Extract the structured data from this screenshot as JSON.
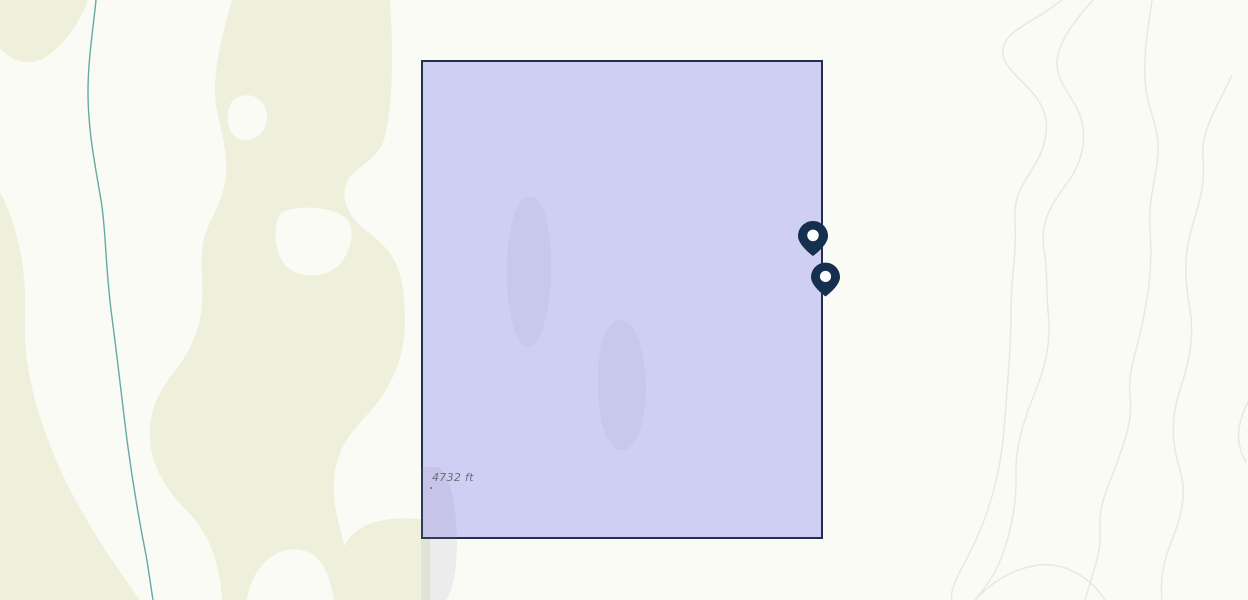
{
  "map": {
    "elevation_marker": {
      "label": "4732 ft"
    },
    "selection": {
      "fill_color": "#cfcef3",
      "border_color": "#22304f"
    },
    "markers": [
      {
        "id": "marker-1",
        "color": "#14304e"
      },
      {
        "id": "marker-2",
        "color": "#14304e"
      }
    ],
    "terrain": {
      "background_color": "#fbfbf6",
      "vegetation_color": "#eef0dc",
      "stream_color": "#65aaa4",
      "contour_color": "#ebe8e0"
    }
  }
}
